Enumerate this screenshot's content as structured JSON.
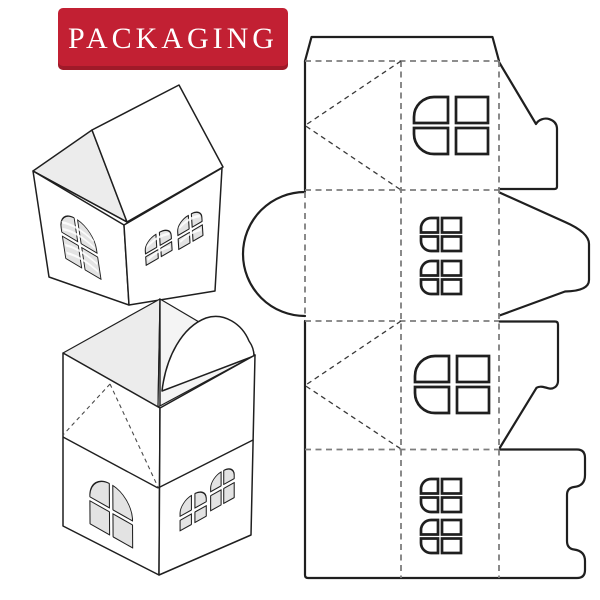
{
  "banner": {
    "title": "PACKAGING"
  },
  "colors": {
    "accent": "#c22033",
    "bg": "#ffffff",
    "line": "#1f1f1f",
    "fold": "#7d7d7d",
    "fold-dark": "#3a3a3a",
    "shade": "#ececec",
    "pane": "#e3e3e3"
  },
  "figures": {
    "mockup_closed": "closed-house-box",
    "mockup_open": "open-house-box",
    "template": "die-cut-layout"
  }
}
